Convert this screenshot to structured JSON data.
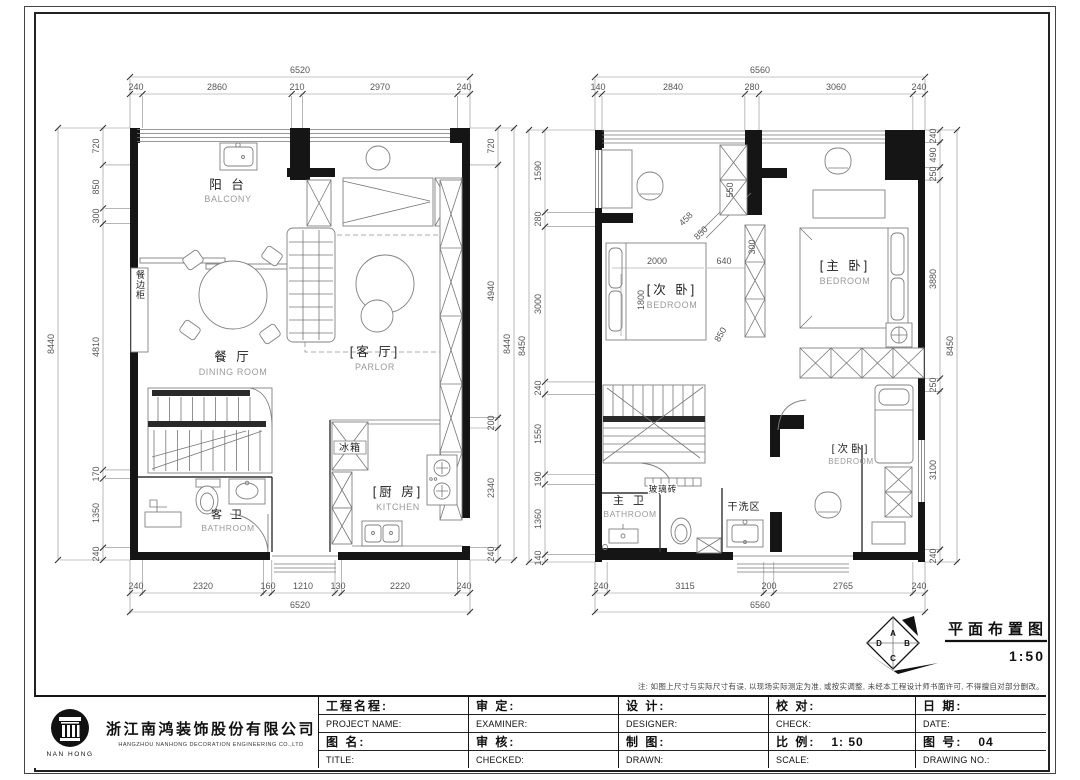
{
  "sheet": {
    "note": "注: 如图上尺寸与实际尺寸有误, 以现场实际测定为准, 或按实调整, 未经本工程设计师书面许可, 不得擅自对部分删改。",
    "drawing_title": "平面布置图",
    "drawing_scale": "1:50",
    "marker_letters": {
      "a": "A",
      "b": "B",
      "c": "C",
      "d": "D"
    }
  },
  "title_block": {
    "company_cn": "浙江南鸿装饰股份有限公司",
    "company_en": "HANGZHOU NANHONG DECORATION ENGINEERING CO.,LTD",
    "logo_text": "NAN HONG",
    "fields": {
      "project_cn": "工程名程:",
      "project_en": "PROJECT NAME:",
      "drawing_cn": "图 名:",
      "drawing_en": "TITLE:",
      "examine_cn": "审  定:",
      "examine_en": "EXAMINER:",
      "audit_cn": "审  核:",
      "audit_en": "CHECKED:",
      "design_cn": "设  计:",
      "design_en": "DESIGNER:",
      "draft_cn": "制  图:",
      "draft_en": "DRAWN:",
      "check_cn": "校  对:",
      "check_en": "CHECK:",
      "scale_cn": "比  例:",
      "scale_value": "1: 50",
      "scale_en": "SCALE:",
      "date_cn": "日  期:",
      "date_en": "DATE:",
      "no_cn": "图  号:",
      "no_value": "04",
      "no_en": "DRAWING NO.:"
    }
  },
  "plan_left": {
    "dims": {
      "top_total": "6520",
      "top": [
        "240",
        "2860",
        "210",
        "2970",
        "240"
      ],
      "left_total": "8440",
      "left": [
        "720",
        "850",
        "300",
        "4810",
        "170",
        "1350",
        "240"
      ],
      "inner_total": "8440",
      "inner": [
        "720",
        "4940",
        "200",
        "2340",
        "240"
      ],
      "bottom_total": "6520",
      "bottom": [
        "240",
        "2320",
        "160",
        "1210",
        "130",
        "2220",
        "240"
      ]
    },
    "labels": {
      "balcony_cn": "阳 台",
      "balcony_en": "BALCONY",
      "dining_cn": "餐 厅",
      "dining_en": "DINING ROOM",
      "parlor_cn": "[客 厅]",
      "parlor_en": "PARLOR",
      "kitchen_cn": "[厨 房]",
      "kitchen_en": "KITCHEN",
      "bath_cn": "客 卫",
      "bath_en": "BATHROOM",
      "fridge": "冰箱",
      "sideboard": "餐边柜"
    }
  },
  "plan_right": {
    "dims": {
      "top_total": "6560",
      "top": [
        "140",
        "2840",
        "280",
        "3060",
        "240"
      ],
      "left_total": "8450",
      "left": [
        "1590",
        "280",
        "3000",
        "240",
        "1550",
        "190",
        "1360",
        "140"
      ],
      "right_total": "8450",
      "right": [
        "240",
        "490",
        "250",
        "3880",
        "250",
        "3100",
        "240"
      ],
      "bottom_total": "6560",
      "bottom": [
        "240",
        "3115",
        "200",
        "2765",
        "240"
      ],
      "interior": [
        "550",
        "458",
        "850",
        "300",
        "640",
        "2000",
        "1800",
        "850"
      ]
    },
    "labels": {
      "bedroom2_cn": "[次 卧]",
      "bedroom2_en": "BEDROOM",
      "master_cn": "[主 卧]",
      "master_en": "BEDROOM",
      "bedroom3_cn": "[次卧]",
      "bedroom3_en": "BEDROOM",
      "bath_cn": "主 卫",
      "bath_en": "BATHROOM",
      "laundry": "干洗区",
      "glassbrick": "玻璃砖"
    }
  }
}
